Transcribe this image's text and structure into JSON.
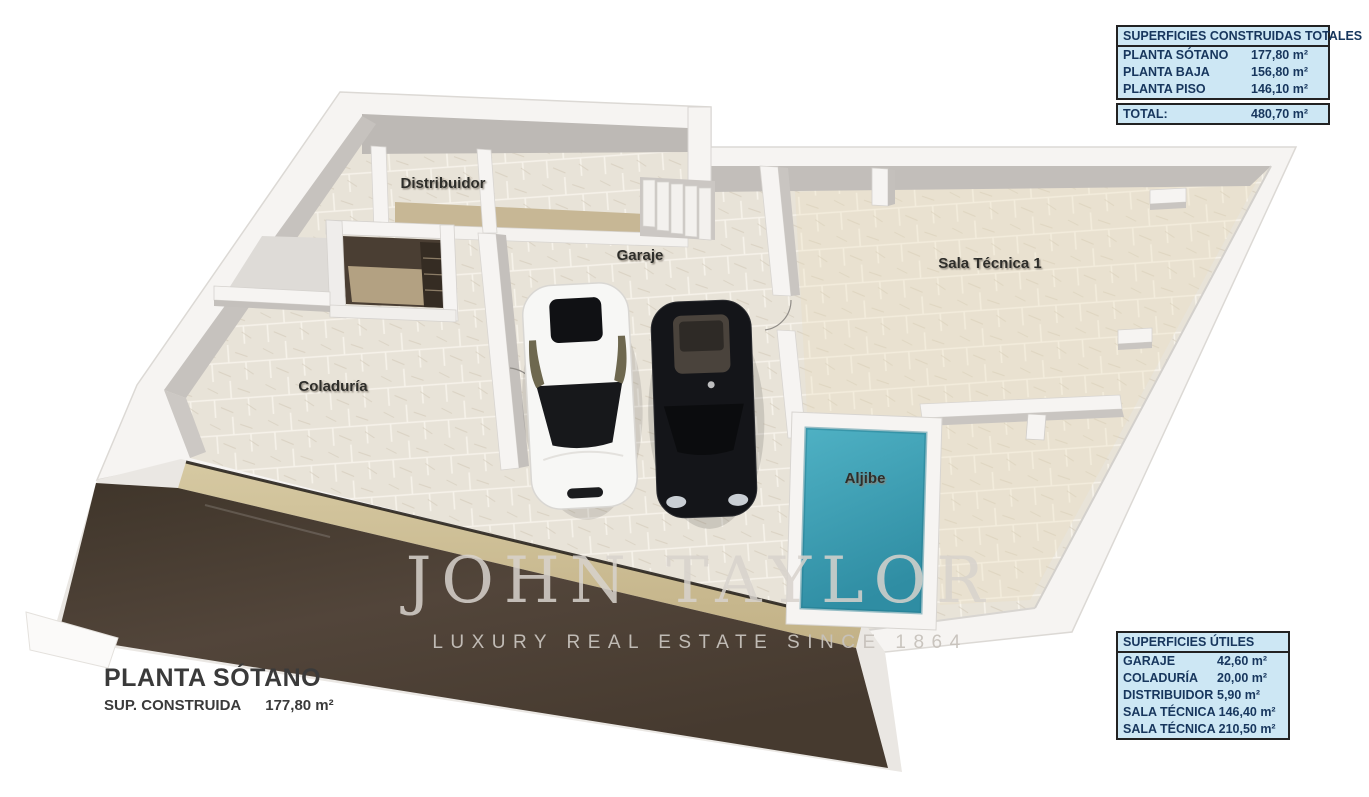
{
  "watermark": {
    "brand": "JOHN TAYLOR",
    "tagline": "LUXURY REAL ESTATE SINCE 1864"
  },
  "title_block": {
    "title": "PLANTA SÓTANO",
    "area_label": "SUP. CONSTRUIDA",
    "area_value": "177,80 m²"
  },
  "tables": {
    "built": {
      "header": "SUPERFICIES CONSTRUIDAS TOTALES",
      "rows": [
        {
          "label": "PLANTA SÓTANO",
          "value": "177,80 m²"
        },
        {
          "label": "PLANTA BAJA",
          "value": "156,80 m²"
        },
        {
          "label": "PLANTA PISO",
          "value": "146,10 m²"
        }
      ],
      "total_label": "TOTAL:",
      "total_value": "480,70 m²"
    },
    "usable": {
      "header": "SUPERFICIES ÚTILES",
      "rows": [
        {
          "label": "GARAJE",
          "value": "42,60 m²"
        },
        {
          "label": "COLADURÍA",
          "value": "20,00 m²"
        },
        {
          "label": "DISTRIBUIDOR",
          "value": "5,90 m²"
        },
        {
          "label": "SALA TÉCNICA 1",
          "value": "46,40 m²"
        },
        {
          "label": "SALA TÉCNICA 2",
          "value": "10,50 m²"
        }
      ]
    }
  },
  "floorplan": {
    "rooms": {
      "distribuidor": "Distribuidor",
      "garaje": "Garaje",
      "sala_tecnica_1": "Sala Técnica 1",
      "coladuria": "Coladuría",
      "aljibe": "Aljibe"
    }
  },
  "colors": {
    "table_bg": "#cde7f4",
    "table_text": "#17365d",
    "aljibe_teal": "#3fa6ba",
    "ramp_brown": "#463b2f",
    "sand": "#c6b584",
    "floor_beige": "#e8e3d8",
    "wall_white": "#f6f4f2"
  }
}
